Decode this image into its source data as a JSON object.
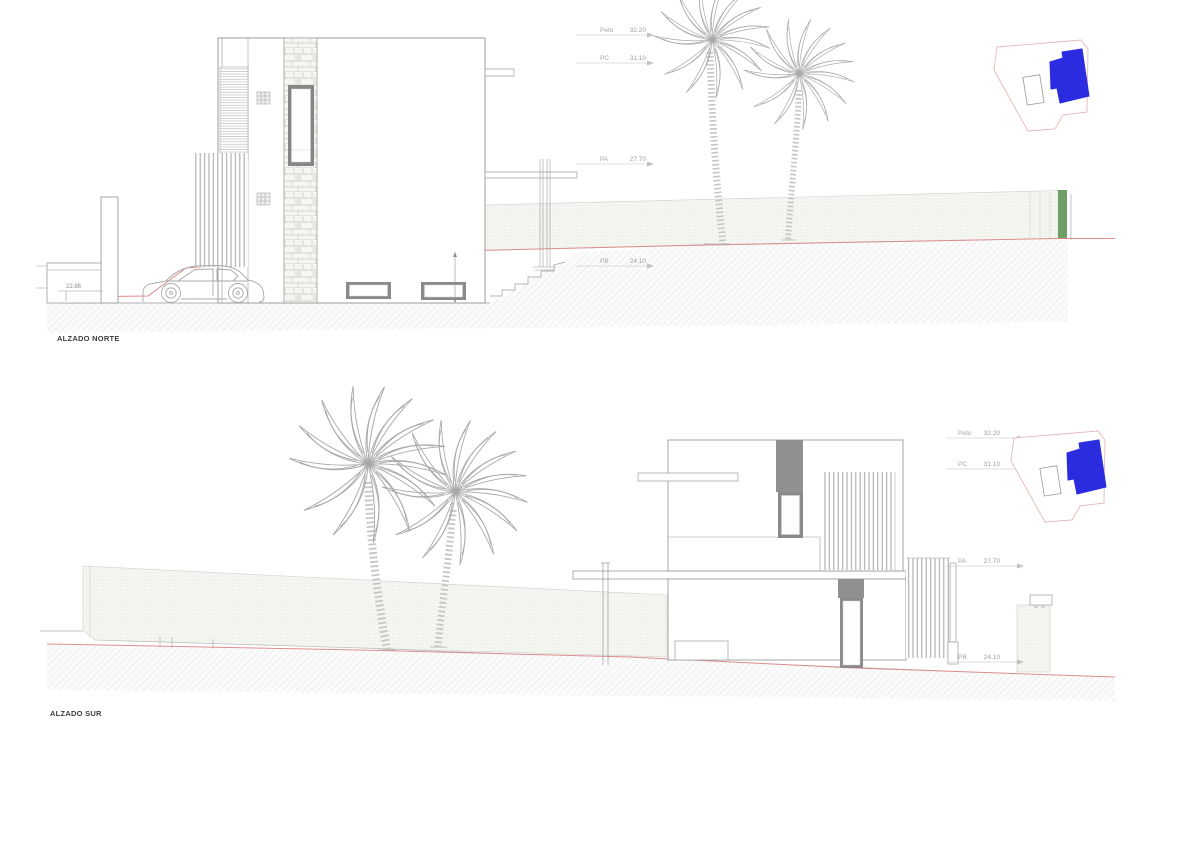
{
  "sheet": {
    "background": "#ffffff"
  },
  "drawings": [
    {
      "title": "ALZADO NORTE",
      "levels": [
        {
          "label": "Peto",
          "value": "32.20"
        },
        {
          "label": "PC",
          "value": "31.10"
        },
        {
          "label": "PA",
          "value": "27.70"
        },
        {
          "label": "PB",
          "value": "24.10"
        }
      ],
      "spot_elevation": "22.86"
    },
    {
      "title": "ALZADO SUR",
      "levels": [
        {
          "label": "Peto",
          "value": "32.20"
        },
        {
          "label": "PC",
          "value": "31.10"
        },
        {
          "label": "PA",
          "value": "27.70"
        },
        {
          "label": "PB",
          "value": "24.10"
        }
      ]
    }
  ],
  "site_key": {
    "highlight_color": "#2b2ce0",
    "plot_outline_color": "#e4b9b9"
  },
  "colors": {
    "terrain_line": "#dd8c8c",
    "accent_green": "#6f9e66",
    "line_gray": "#9c9c9c"
  }
}
